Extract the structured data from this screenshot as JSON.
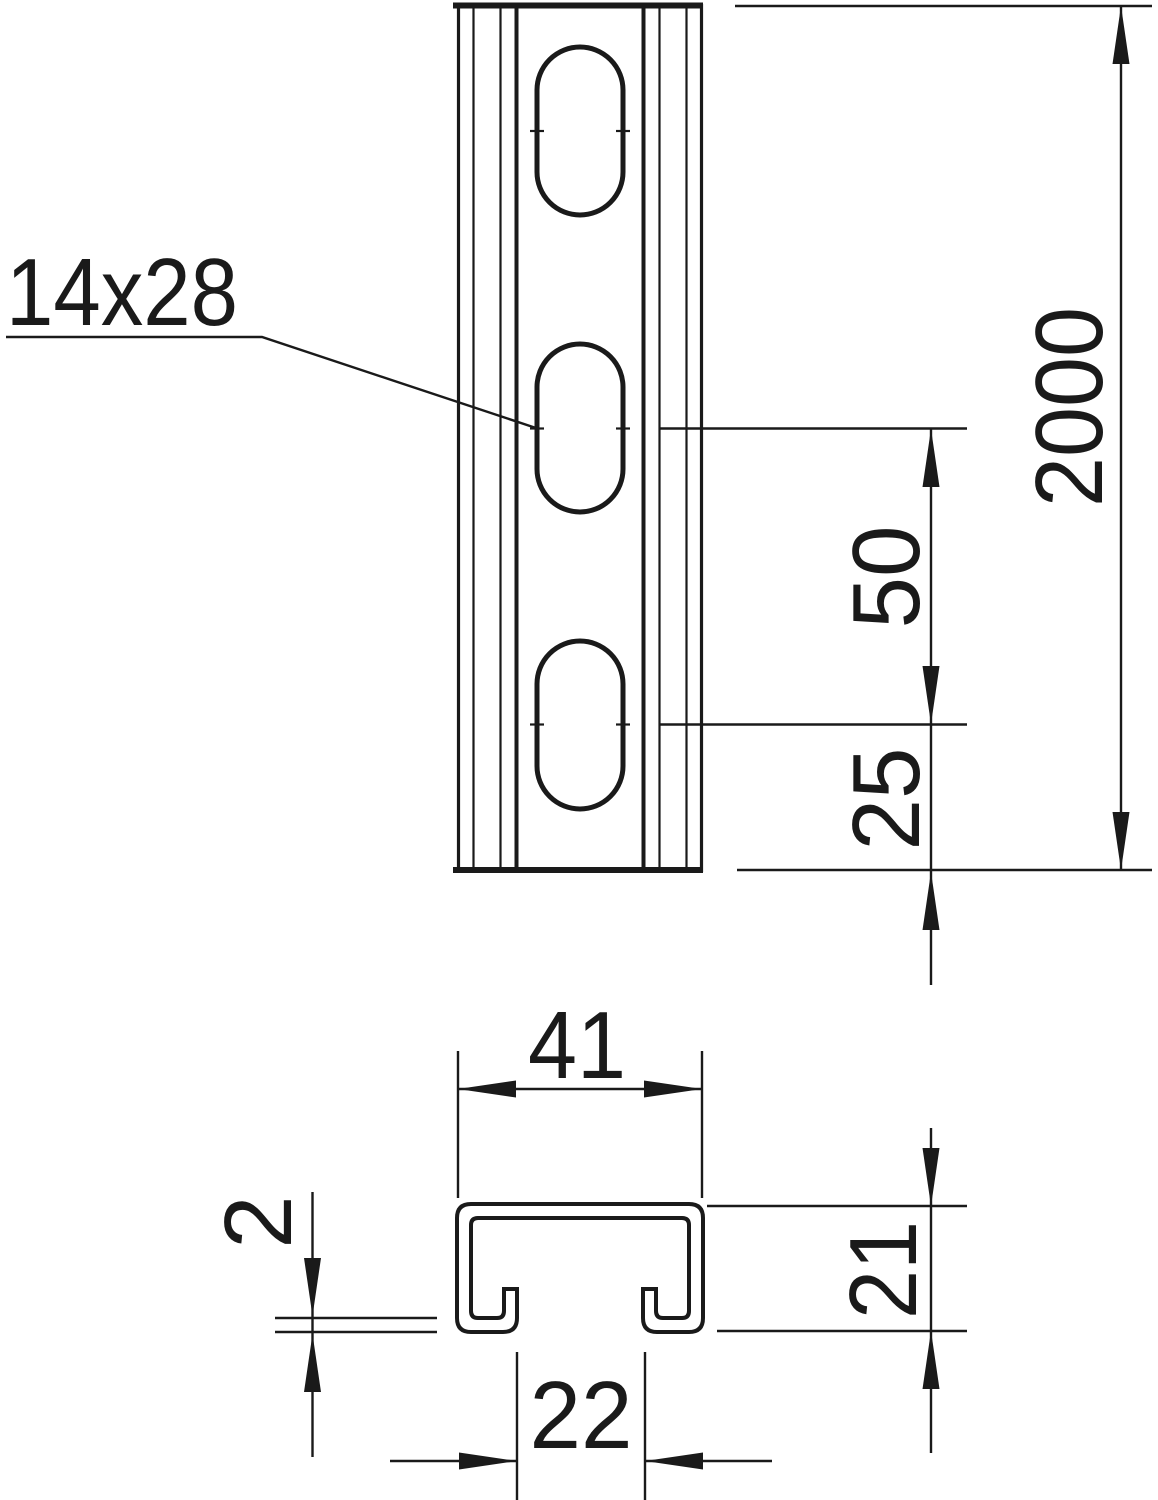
{
  "drawing": {
    "title": "slotted mounting rail technical drawing",
    "background": "#ffffff",
    "ink_color": "#1a1a1a",
    "views": {
      "front_view": "rail front view with oblong slots",
      "section_view": "C-profile cross-section"
    },
    "labels": {
      "slot_size": "14x28",
      "rail_length": "2000",
      "slot_pitch": "50",
      "end_distance": "25",
      "profile_width": "41",
      "material_thickness": "2",
      "profile_height": "21",
      "slot_opening": "22"
    }
  }
}
